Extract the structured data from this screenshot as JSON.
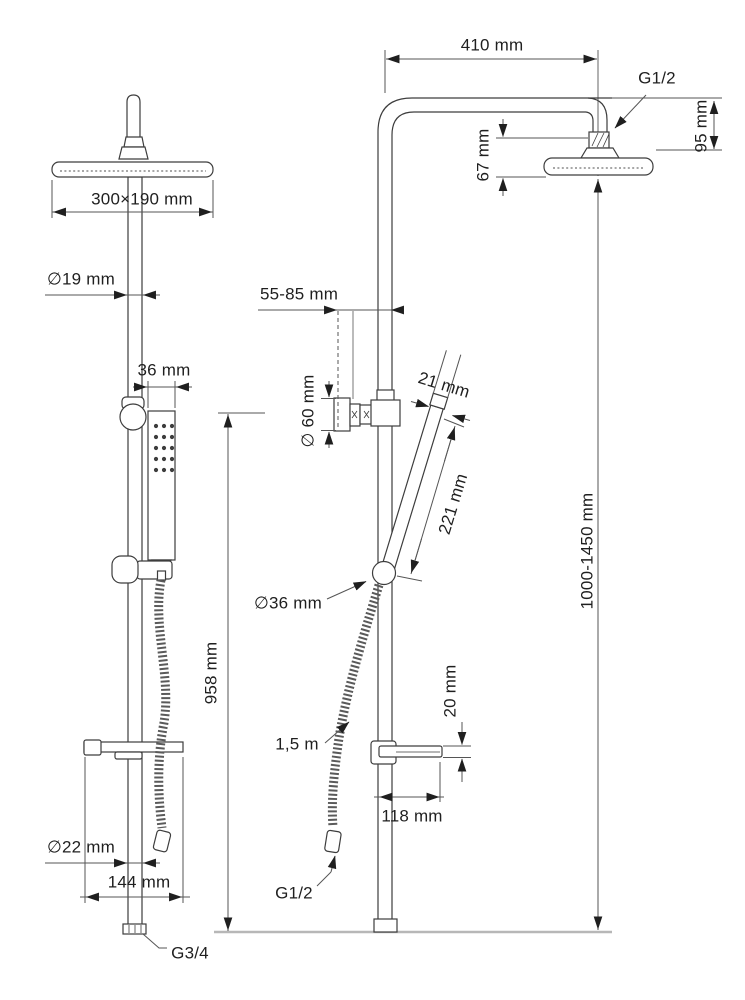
{
  "drawing": {
    "type": "shower-system-technical-drawing",
    "views": [
      "front",
      "side"
    ],
    "annotations": {
      "arm_reach": "410 mm",
      "top_thread": "G1/2",
      "head_to_arm_top": "95 mm",
      "head_drop": "67 mm",
      "head_size": "300×190 mm",
      "upper_pipe_diameter": "∅19 mm",
      "wall_distance": "55-85 mm",
      "bracket_diameter": "∅ 60 mm",
      "handshower_width": "21 mm",
      "handshower_length": "221 mm",
      "handshower_body_width": "36 mm",
      "slider_diameter": "∅36 mm",
      "bar_height": "958 mm",
      "column_height": "1000-1450 mm",
      "hose_length": "1,5 m",
      "shelf_thickness": "20 mm",
      "shelf_depth": "118 mm",
      "lower_pipe_diameter": "∅22 mm",
      "shelf_width": "144 mm",
      "hose_thread": "G1/2",
      "bottom_thread": "G3/4"
    }
  }
}
